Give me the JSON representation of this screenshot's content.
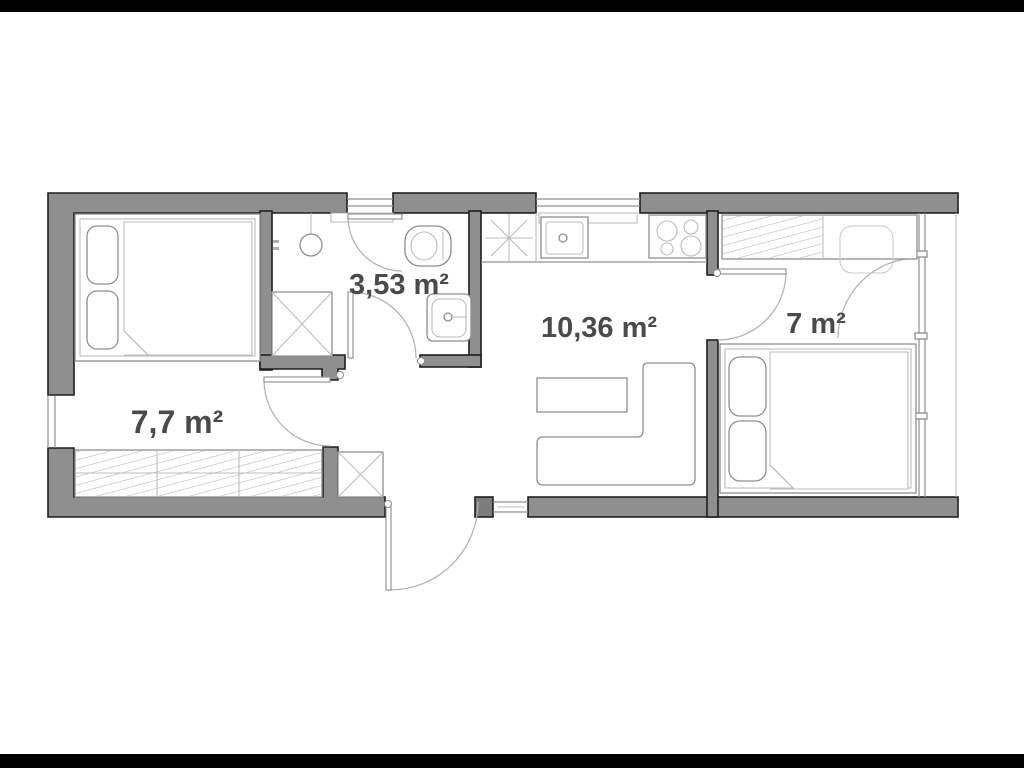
{
  "plan": {
    "title": "apartment-floor-plan",
    "rooms": [
      {
        "id": "bedroom-1",
        "area_label": "7,7 m²"
      },
      {
        "id": "bathroom",
        "area_label": "3,53 m²"
      },
      {
        "id": "living-kitchen",
        "area_label": "10,36 m²"
      },
      {
        "id": "bedroom-2",
        "area_label": "7 m²"
      }
    ],
    "fixtures": [
      "double-bed",
      "wardrobe",
      "shower-cabin",
      "toilet",
      "washbasin",
      "ceiling-lamp",
      "kitchen-sink",
      "cooktop-4-burner",
      "boiler-star-symbol",
      "dining-table",
      "corner-sofa",
      "entry-cabinet",
      "desk-wardrobe",
      "chair",
      "entry-door",
      "interior-door",
      "balcony-door",
      "window"
    ],
    "colors": {
      "wall_fill": "#8f8f8f",
      "wall_outline": "#1f1f1f",
      "line": "#8f8f8f",
      "line_light": "#bdbdbd",
      "label_text": "#4a4a4a",
      "background": "#ffffff",
      "letterbox": "#000000"
    }
  }
}
